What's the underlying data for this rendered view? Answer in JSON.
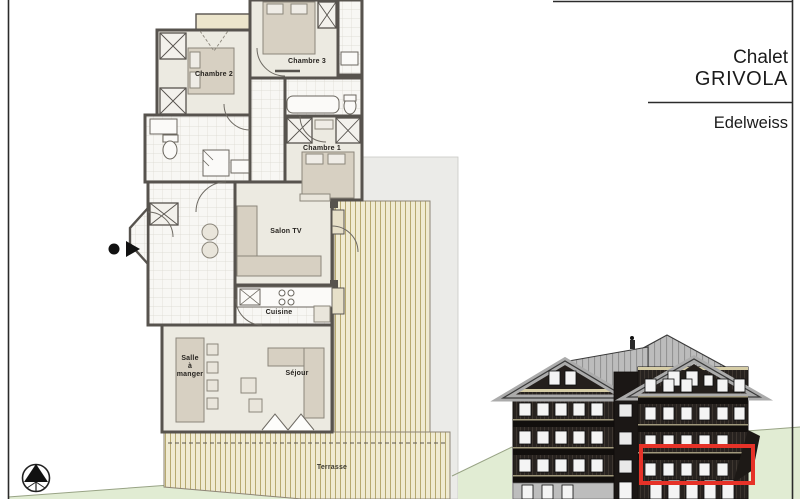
{
  "title_block": {
    "project_line1": "Chalet",
    "project_line2": "GRIVOLA",
    "unit_name": "Edelweiss"
  },
  "floor_plan": {
    "room_labels": {
      "chambre2": "Chambre 2",
      "chambre3": "Chambre 3",
      "chambre1": "Chambre 1",
      "salon_tv": "Salon TV",
      "cuisine": "Cuisine",
      "salle_a_manger": "Salle\nà\nmanger",
      "sejour": "Séjour",
      "terrasse": "Terrasse"
    },
    "icons": {
      "north_arrow": "compass-north-icon",
      "entrance_marker": "entrance-arrow-icon"
    }
  },
  "elevation": {
    "description": "chalet facade with highlighted unit",
    "highlight_color": "#e63228"
  },
  "colors": {
    "wall": "#57534e",
    "room_floor": "#eceae1",
    "tile_floor": "#f8f7f4",
    "furniture": "#d7d0c2",
    "deck": "#f0ebd2",
    "deck_line": "#b7a970",
    "lawn": "#e1ecd3",
    "roof": "#bcbcbc",
    "facade": "#27221f",
    "highlight_red": "#e63228"
  }
}
